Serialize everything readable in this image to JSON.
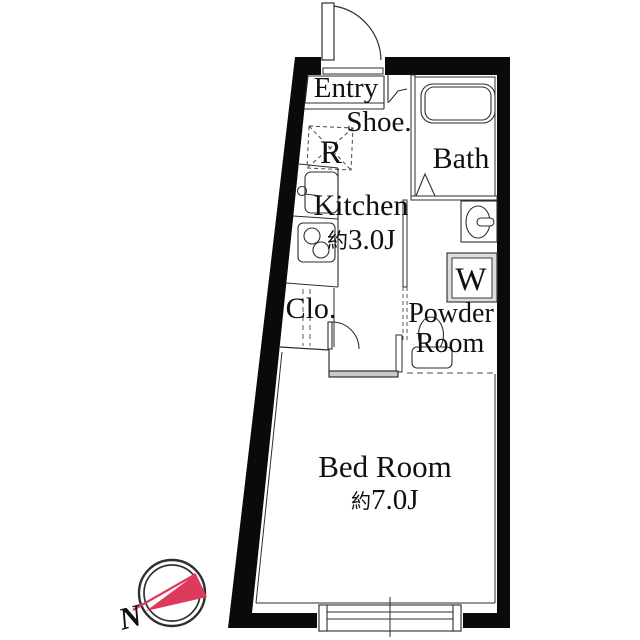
{
  "plan": {
    "entry": {
      "label": "Entry"
    },
    "shoe": {
      "label": "Shoe."
    },
    "fridge": {
      "label": "R"
    },
    "bath": {
      "label": "Bath"
    },
    "kitchen": {
      "label": "Kitchen",
      "size_prefix": "約",
      "size": "3.0J"
    },
    "closet": {
      "label": "Clo."
    },
    "washer": {
      "label": "W"
    },
    "powder_room": {
      "label_line1": "Powder",
      "label_line2": "Room"
    },
    "bedroom": {
      "label": "Bed Room",
      "size_prefix": "約",
      "size": "7.0J"
    },
    "compass": {
      "label": "N"
    }
  },
  "colors": {
    "wall": "#0a0a0a",
    "line": "#2e2e2e",
    "wall_fill_gray": "#c9c9c9",
    "compass_accent": "#dd3a5e"
  }
}
